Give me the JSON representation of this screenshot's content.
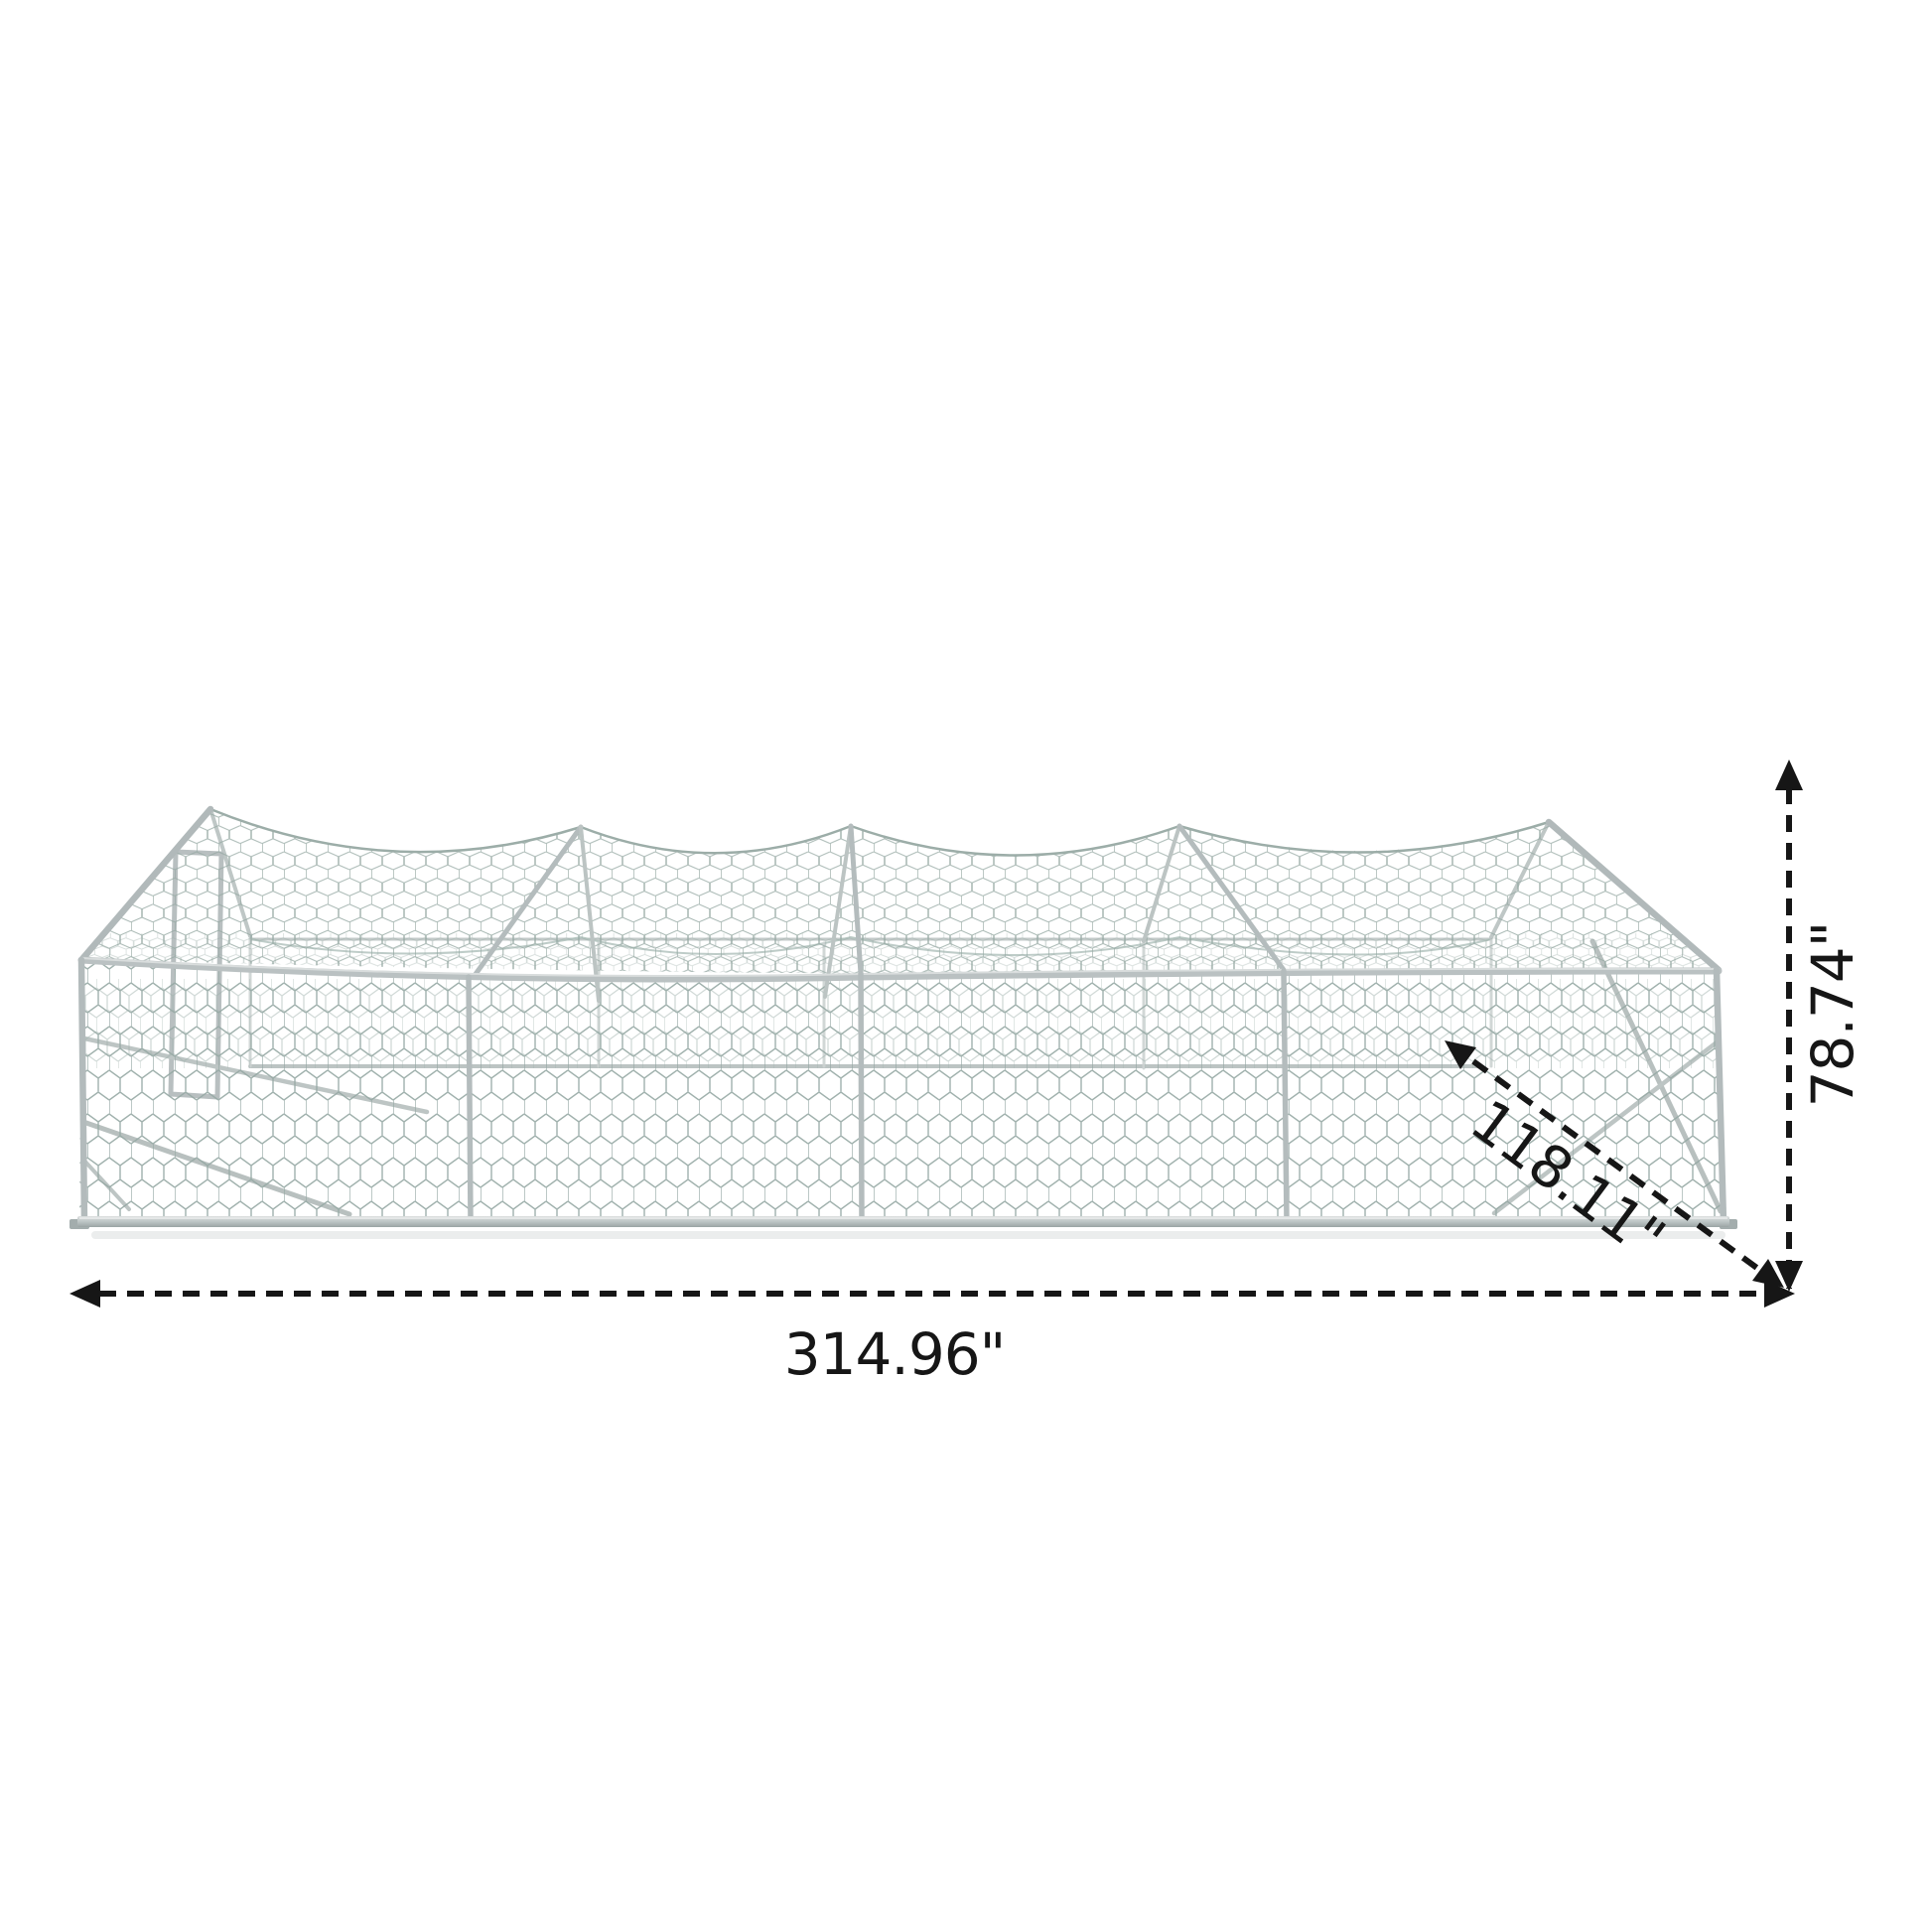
{
  "diagram": {
    "subject": "walk-in chicken run cage with hexagonal wire mesh",
    "background_color": "#ffffff",
    "frame_color": "#b3bbbc",
    "mesh_color": "#96a9a4",
    "annotation_color": "#161616",
    "shadow_color": "#e7eaea"
  },
  "dimensions": {
    "width": {
      "value": "314.96\"",
      "orientation": "horizontal",
      "position": "bottom"
    },
    "height": {
      "value": "78.74\"",
      "orientation": "vertical",
      "position": "right"
    },
    "depth": {
      "value": "118.11\"",
      "orientation": "diagonal",
      "position": "bottom-right"
    }
  }
}
